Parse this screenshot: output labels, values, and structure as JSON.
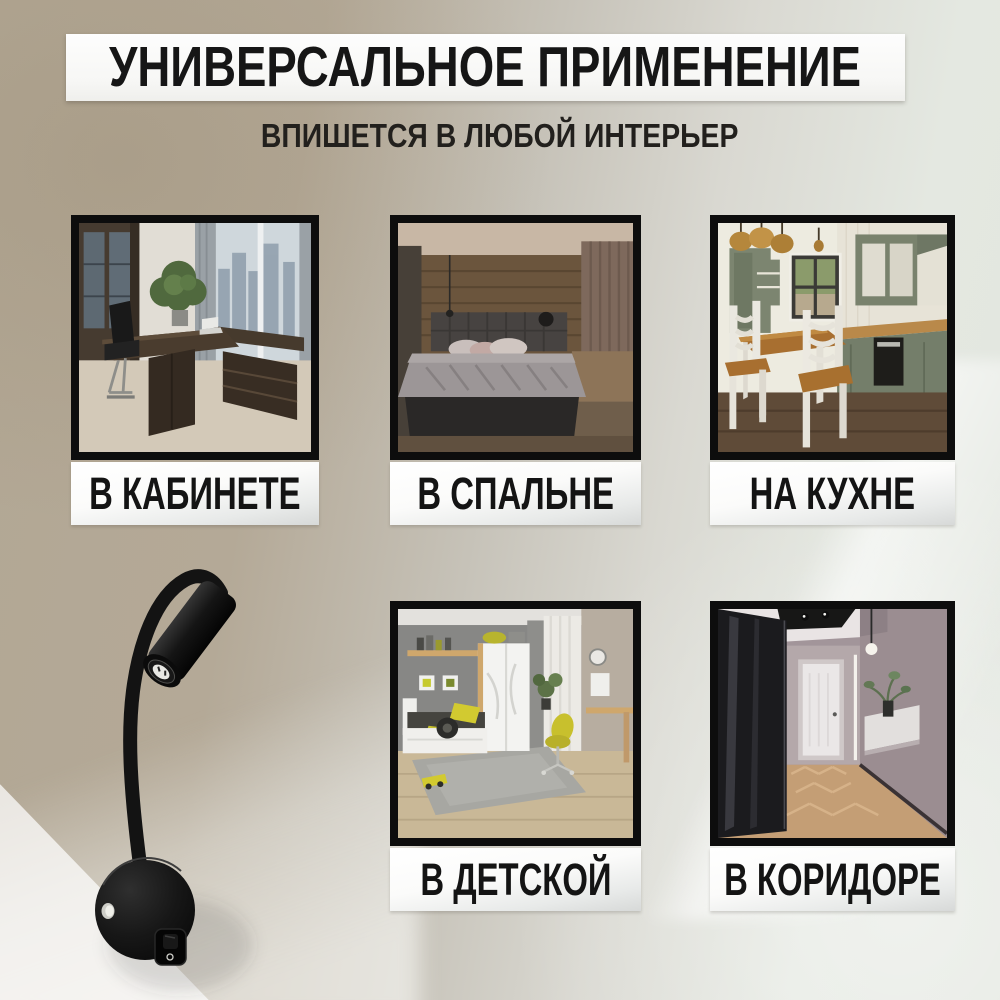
{
  "header": {
    "title": "УНИВЕРСАЛЬНОЕ ПРИМЕНЕНИЕ",
    "subtitle": "ВПИШЕТСЯ В ЛЮБОЙ ИНТЕРЬЕР"
  },
  "tiles": [
    {
      "label": "В КАБИНЕТЕ",
      "photo": "office-room-photo"
    },
    {
      "label": "В СПАЛЬНЕ",
      "photo": "bedroom-photo"
    },
    {
      "label": "НА КУХНЕ",
      "photo": "kitchen-photo"
    },
    {
      "label": "В ДЕТСКОЙ",
      "photo": "kids-room-photo"
    },
    {
      "label": "В КОРИДОРЕ",
      "photo": "hallway-photo"
    }
  ],
  "product": {
    "photo": "black-flexible-gooseneck-wall-lamp"
  },
  "colors": {
    "background_left": "#b3a795",
    "background_right": "#e3e7e0",
    "banner_background": "#f8f8f7",
    "plate_top": "#ffffff",
    "plate_bottom": "#d7d9d8",
    "text": "#141414",
    "tile_border": "#0d0d0d"
  }
}
